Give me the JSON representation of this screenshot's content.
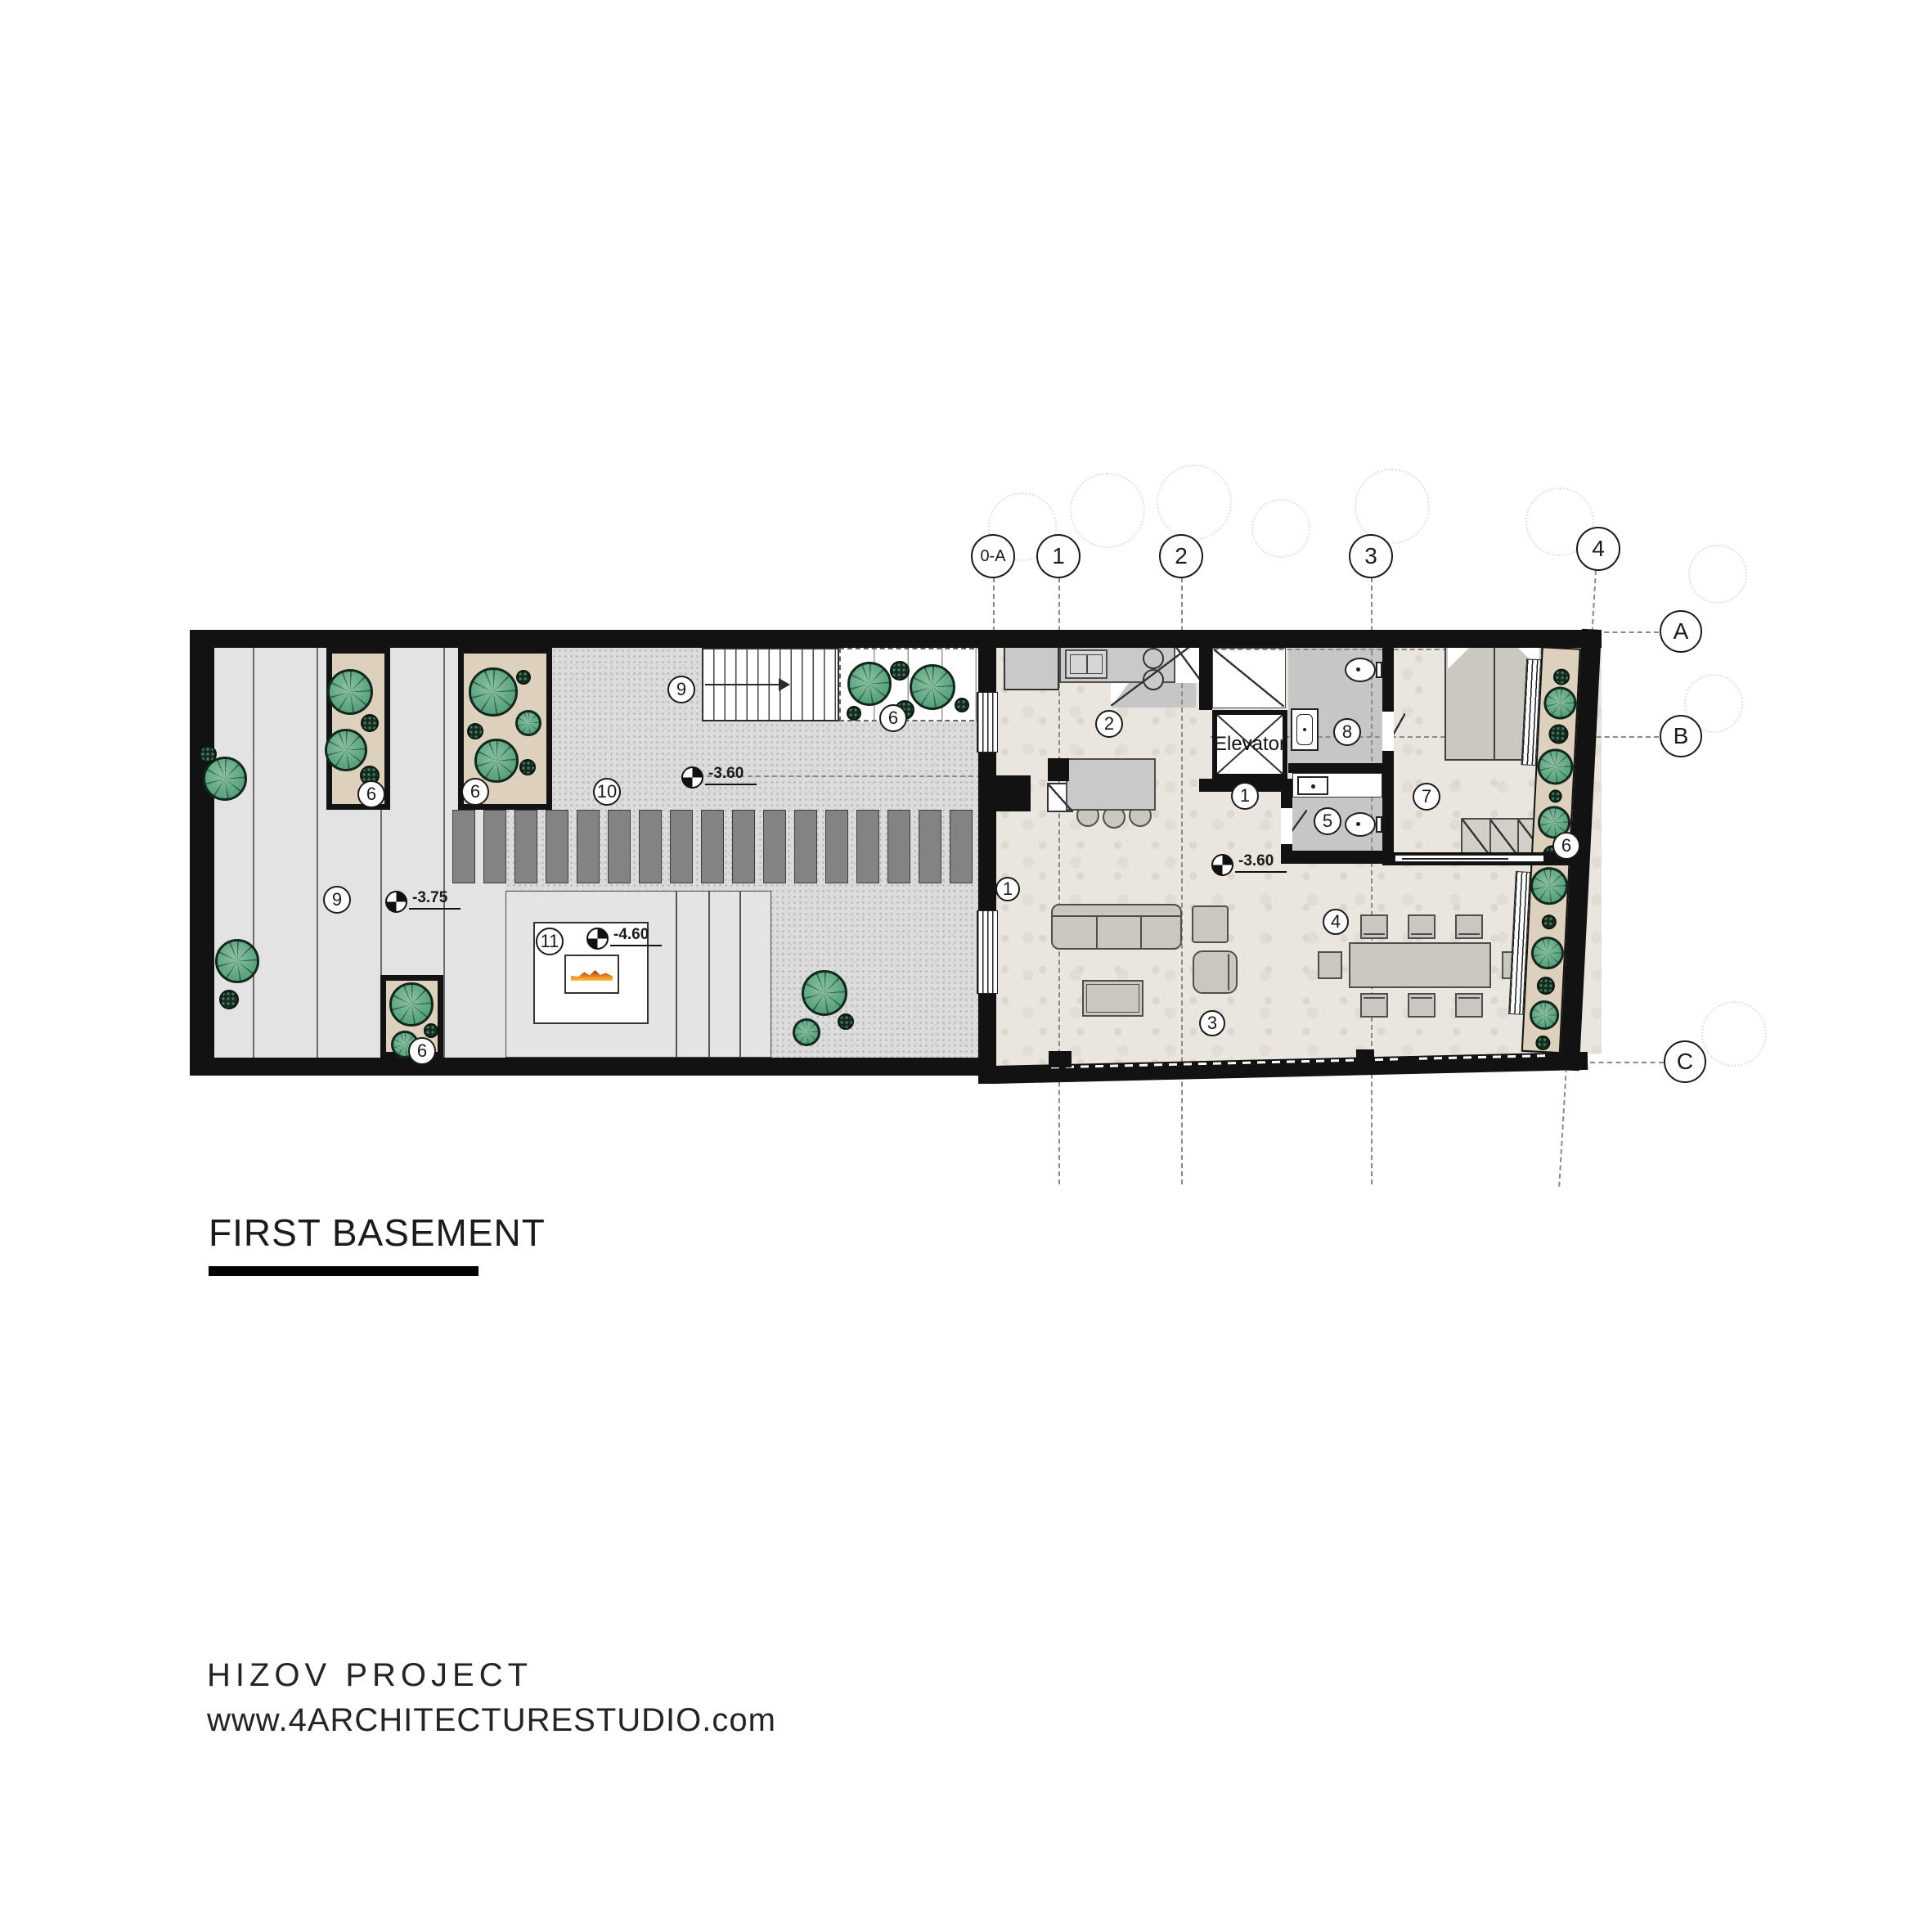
{
  "title": {
    "text": "FIRST BASEMENT"
  },
  "footer": {
    "line1": "HIZOV  PROJECT",
    "line2": "www.4ARCHITECTURESTUDIO.com"
  },
  "grid": {
    "top": [
      "0-A",
      "1",
      "2",
      "3",
      "4"
    ],
    "right": [
      "A",
      "B",
      "C"
    ]
  },
  "elevator_label": "Elevator",
  "areas": [
    {
      "id": "hall",
      "label": "1"
    },
    {
      "id": "entry-door",
      "label": "1"
    },
    {
      "id": "kitchen",
      "label": "2"
    },
    {
      "id": "living",
      "label": "3"
    },
    {
      "id": "dining",
      "label": "4"
    },
    {
      "id": "wc",
      "label": "5"
    },
    {
      "id": "bedroom",
      "label": "7"
    },
    {
      "id": "bath",
      "label": "8"
    },
    {
      "id": "walkway",
      "label": "9"
    },
    {
      "id": "garden-stairs",
      "label": "9"
    },
    {
      "id": "gravel-court",
      "label": "10"
    },
    {
      "id": "fire-lounge",
      "label": "11"
    },
    {
      "id": "planter-1",
      "label": "6"
    },
    {
      "id": "planter-2",
      "label": "6"
    },
    {
      "id": "planter-3",
      "label": "6"
    },
    {
      "id": "planter-4",
      "label": "6"
    },
    {
      "id": "planter-5",
      "label": "6"
    }
  ],
  "elevations": [
    {
      "id": "walkway",
      "value": "-3.75"
    },
    {
      "id": "court",
      "value": "-3.60"
    },
    {
      "id": "living",
      "value": "-3.60"
    },
    {
      "id": "fire-lounge",
      "value": "-4.60"
    }
  ],
  "colors": {
    "wall": "#121212",
    "floor": "#eae6df",
    "gravel": "#dcdcdc",
    "gravel-dot": "#b9b9b9",
    "strip": "#e3e3e3",
    "tan": "#ddd0bc",
    "bath": "#c6c6c6",
    "furn": "#cac7c1",
    "bar": "#838383",
    "tree": "#5ea581",
    "tree-line": "#12281e",
    "fire": "#e87f1e"
  }
}
